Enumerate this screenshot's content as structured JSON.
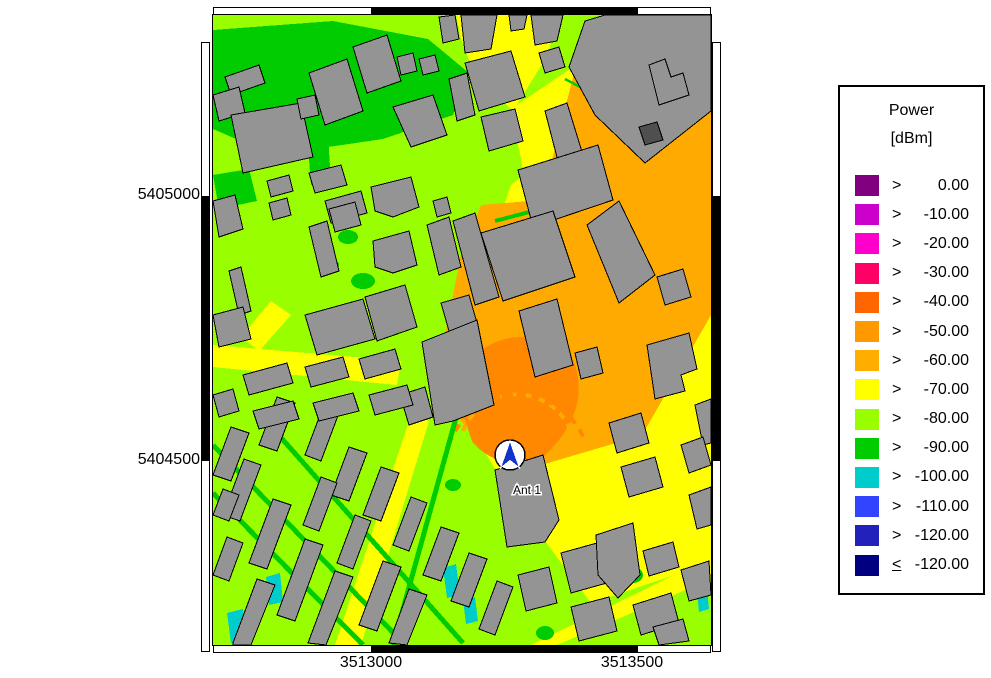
{
  "palette": {
    "lg": "#99FF00",
    "grn": "#00CC00",
    "yel": "#FFFF00",
    "org": "#FFAA00",
    "dorg": "#FF8800",
    "cyn": "#00CCCC",
    "bld": "#949494",
    "bldd": "#4F4F4F",
    "ant": "#1133CC"
  },
  "map": {
    "antenna_label": "Ant 1",
    "x_ticks": [
      "3513000",
      "3513500"
    ],
    "y_ticks": [
      "5405000",
      "5404500"
    ]
  },
  "legend": {
    "title_line1": "Power",
    "title_line2": "[dBm]",
    "rows": [
      {
        "op": ">",
        "value": "0.00",
        "color": "#800080"
      },
      {
        "op": ">",
        "value": "-10.00",
        "color": "#CC00CC"
      },
      {
        "op": ">",
        "value": "-20.00",
        "color": "#FF00CC"
      },
      {
        "op": ">",
        "value": "-30.00",
        "color": "#FF0066"
      },
      {
        "op": ">",
        "value": "-40.00",
        "color": "#FF6600"
      },
      {
        "op": ">",
        "value": "-50.00",
        "color": "#FF9900"
      },
      {
        "op": ">",
        "value": "-60.00",
        "color": "#FFAE00"
      },
      {
        "op": ">",
        "value": "-70.00",
        "color": "#FFFF00"
      },
      {
        "op": ">",
        "value": "-80.00",
        "color": "#99FF00"
      },
      {
        "op": ">",
        "value": "-90.00",
        "color": "#00CC00"
      },
      {
        "op": ">",
        "value": "-100.00",
        "color": "#00CCCC"
      },
      {
        "op": ">",
        "value": "-110.00",
        "color": "#3344FF"
      },
      {
        "op": ">",
        "value": "-120.00",
        "color": "#2222BB"
      },
      {
        "op": "<",
        "value": "-120.00",
        "color": "#000080"
      }
    ]
  }
}
